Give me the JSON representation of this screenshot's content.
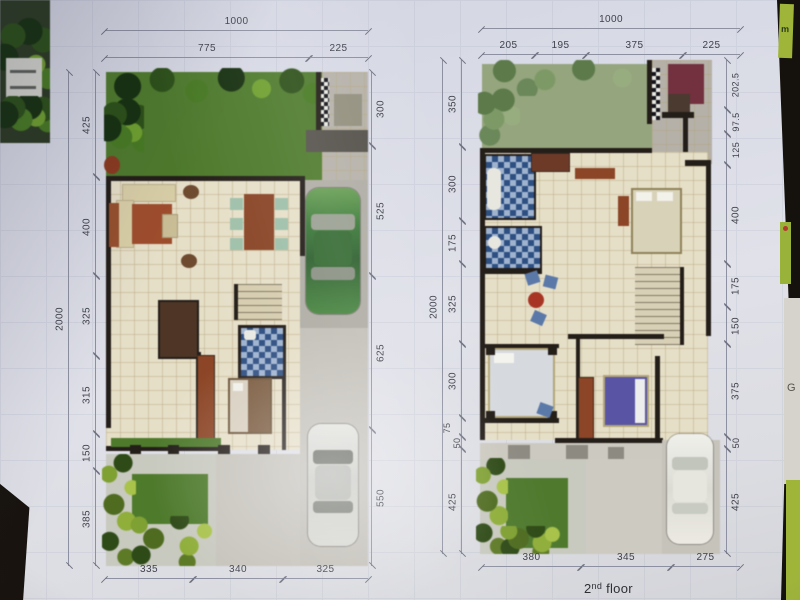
{
  "photo": {
    "caption": {
      "num": "2",
      "sup": "nd",
      "rest": "floor"
    },
    "stray": {
      "right_edge_letter": "G",
      "top_right_tab": "m"
    }
  },
  "plan1": {
    "top_total": "1000",
    "top_segments": [
      "775",
      "225"
    ],
    "left_total": "2000",
    "left_segments": [
      "425",
      "400",
      "325",
      "315",
      "150",
      "385"
    ],
    "right_segments": [
      "300",
      "525",
      "625",
      "550"
    ],
    "bottom_segments": [
      "335",
      "340",
      "325"
    ]
  },
  "plan2": {
    "top_total": "1000",
    "top_segments": [
      "205",
      "195",
      "375",
      "225"
    ],
    "left_total": "2000",
    "left_segments": [
      "350",
      "300",
      "175",
      "325",
      "300",
      "75",
      "50",
      "425"
    ],
    "right_segments": [
      "202.5",
      "97.5",
      "125",
      "400",
      "175",
      "150",
      "375",
      "50",
      "425"
    ],
    "bottom_segments": [
      "380",
      "345",
      "275"
    ]
  },
  "colors": {
    "page": "#dfe0e8",
    "lawn": "#4e7a2c",
    "roof_lawn": "#95a57e",
    "tile_floor": "#e6dfc8",
    "wall": "#241e19",
    "terracotta": "#9e4d2c",
    "bath_blue": "#5b79a8",
    "car_green": "#3c7a3a",
    "car_silver": "#d4d4cf",
    "car_white": "#eceae4",
    "bed_purple": "#5a54a4",
    "maroon": "#73303e",
    "concrete": "#b6b2aa"
  }
}
